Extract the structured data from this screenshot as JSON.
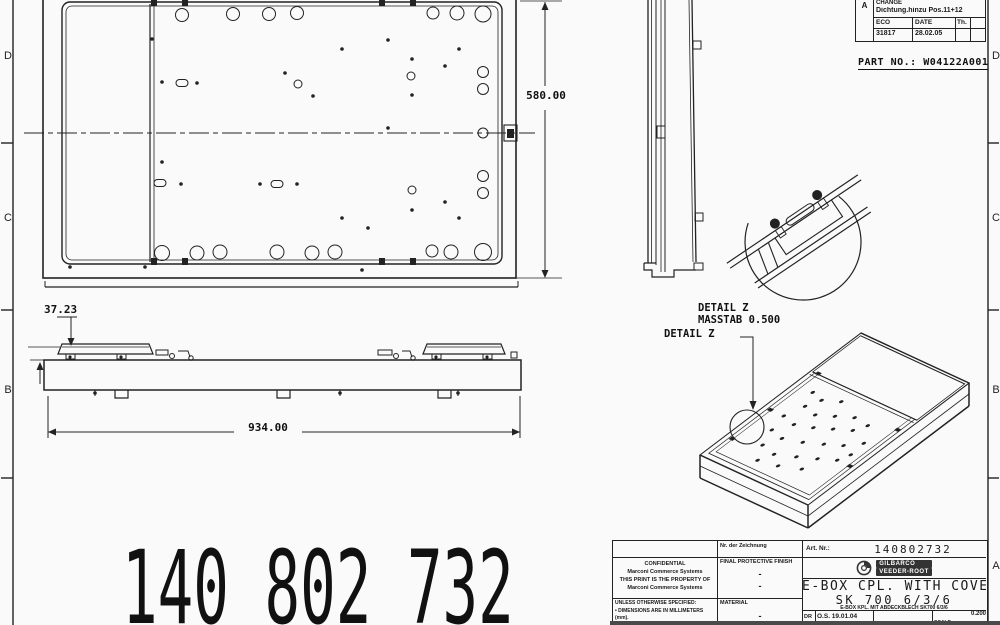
{
  "revision_table": {
    "rev_letter": "A",
    "change_label": "CHANGE",
    "change_text": "Dichtung.hinzu Pos.11+12",
    "eco_label": "ECO",
    "eco_value": "31817",
    "date_label": "DATE",
    "date_value": "28.02.05",
    "th_label": "Th."
  },
  "part_no": "PART NO.: W04122A001",
  "dimensions": {
    "height": "580.00",
    "rail_height": "37.23",
    "length": "934.00"
  },
  "detail": {
    "title": "DETAIL Z",
    "scale": "MASSTAB 0.500",
    "callout": "DETAIL Z"
  },
  "zones": {
    "left": [
      "D",
      "C",
      "B"
    ],
    "right": [
      "D",
      "C",
      "B",
      "A"
    ]
  },
  "big_number": "140 802 732",
  "title_block": {
    "drawing_no_label": "Nr. der Zeichnung",
    "art_no_label": "Art. Nr.:",
    "art_no_value": "140802732",
    "confidential": [
      "CONFIDENTIAL",
      "Marconi Commerce Systems",
      "THIS PRINT IS THE PROPERTY OF",
      "Marconi Commerce Systems"
    ],
    "finish_label": "FINAL PROTECTIVE FINISH",
    "finish_values": [
      "-",
      "-"
    ],
    "spec_lines": [
      "UNLESS OTHERWISE SPECIFIED:",
      "• DIMENSIONS ARE IN MILLIMETERS (mm).",
      "• FOR TOLERANCES SEE THE"
    ],
    "material_label": "MATERIAL",
    "material_value": "-",
    "logo_line1": "GILBARCO",
    "logo_line2": "VEEDER-ROOT",
    "title_line1": "E-BOX CPL. WITH COVER",
    "title_line2": "SK 700 6/3/6",
    "subtitle_de": "E-BOX KPL. MIT ABDECKBLECH SK700 6/3/6",
    "dr_label": "DR",
    "dr_value": "O.S. 19.01.04",
    "scale_label": "SCALE",
    "scale_note": "DO NOT SCALE",
    "scale_value": "0.200"
  }
}
